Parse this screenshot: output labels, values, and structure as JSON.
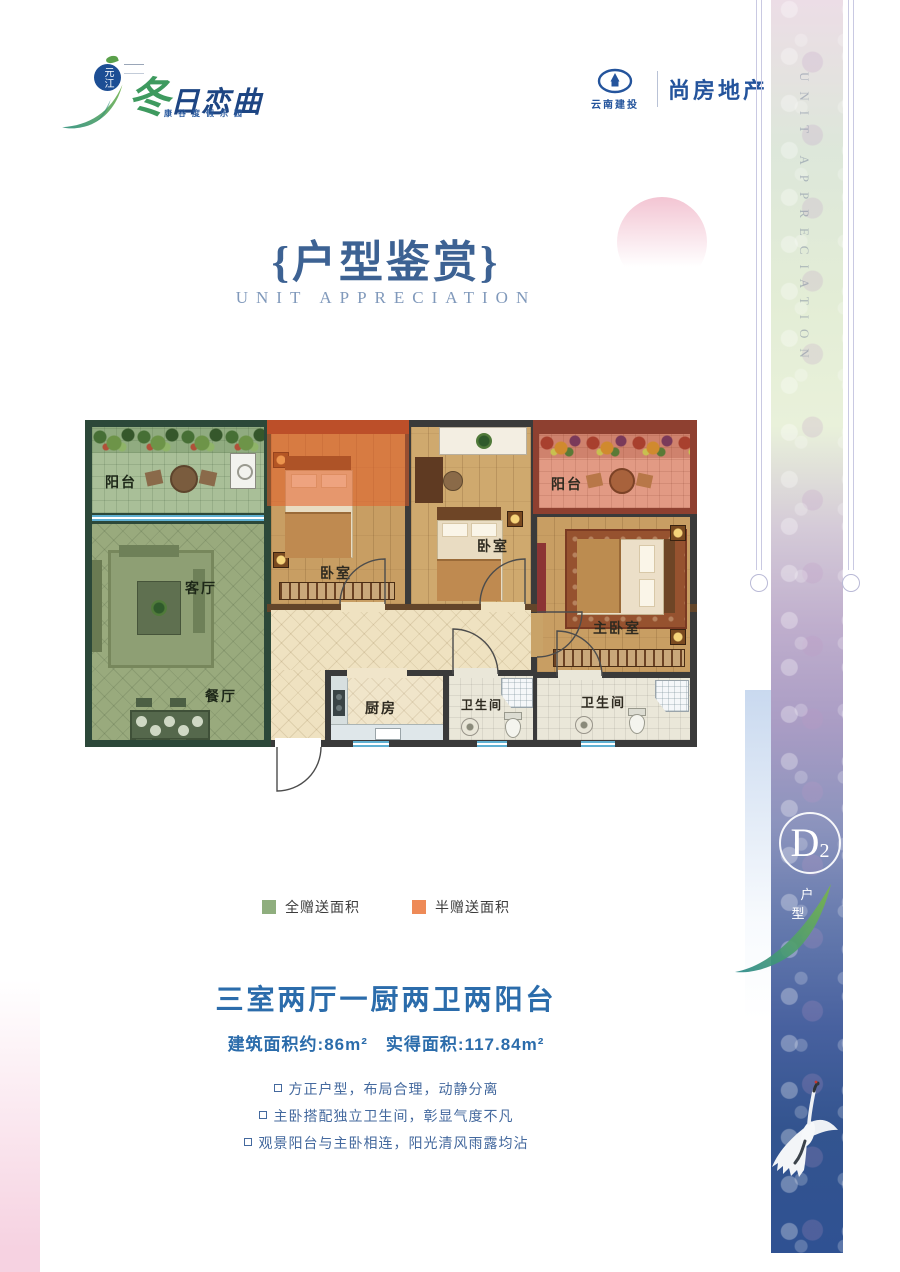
{
  "brand": {
    "badge_text": "元江",
    "logo_green_char": "冬",
    "logo_blue_chars": "日恋曲",
    "tagline": "康谷度假乐园",
    "partner_org": "云南建投",
    "partner_brand": "尚房地产"
  },
  "header": {
    "title": "{户型鉴赏}",
    "subtitle": "UNIT APPRECIATION"
  },
  "floorplan": {
    "rooms": {
      "balcony_left": "阳台",
      "living": "客厅",
      "dining": "餐厅",
      "bedroom1": "卧室",
      "bedroom2": "卧室",
      "balcony_right": "阳台",
      "master": "主卧室",
      "kitchen": "厨房",
      "bath1": "卫生间",
      "bath2": "卫生间"
    },
    "legend": {
      "full_gift_label": "全赠送面积",
      "full_gift_color": "#8fae7e",
      "half_gift_label": "半赠送面积",
      "half_gift_color": "#ee8a57"
    }
  },
  "summary": {
    "layout_title": "三室两厅一厨两卫两阳台",
    "area_built": "建筑面积约:86m²",
    "area_actual": "实得面积:117.84m²",
    "features": [
      "方正户型，布局合理，动静分离",
      "主卧搭配独立卫生间，彰显气度不凡",
      "观景阳台与主卧相连，阳光清风雨露均沾"
    ]
  },
  "side_strip": {
    "vertical_text": "UNIT APPRECIATION",
    "unit_code_main": "D",
    "unit_code_sub": "2",
    "unit_type_label": "户型"
  },
  "colors": {
    "accent_blue": "#2b6cab",
    "title_blue": "#3d6293",
    "full_gift_green": "#8fae7e",
    "half_gift_orange": "#ee8a57"
  }
}
